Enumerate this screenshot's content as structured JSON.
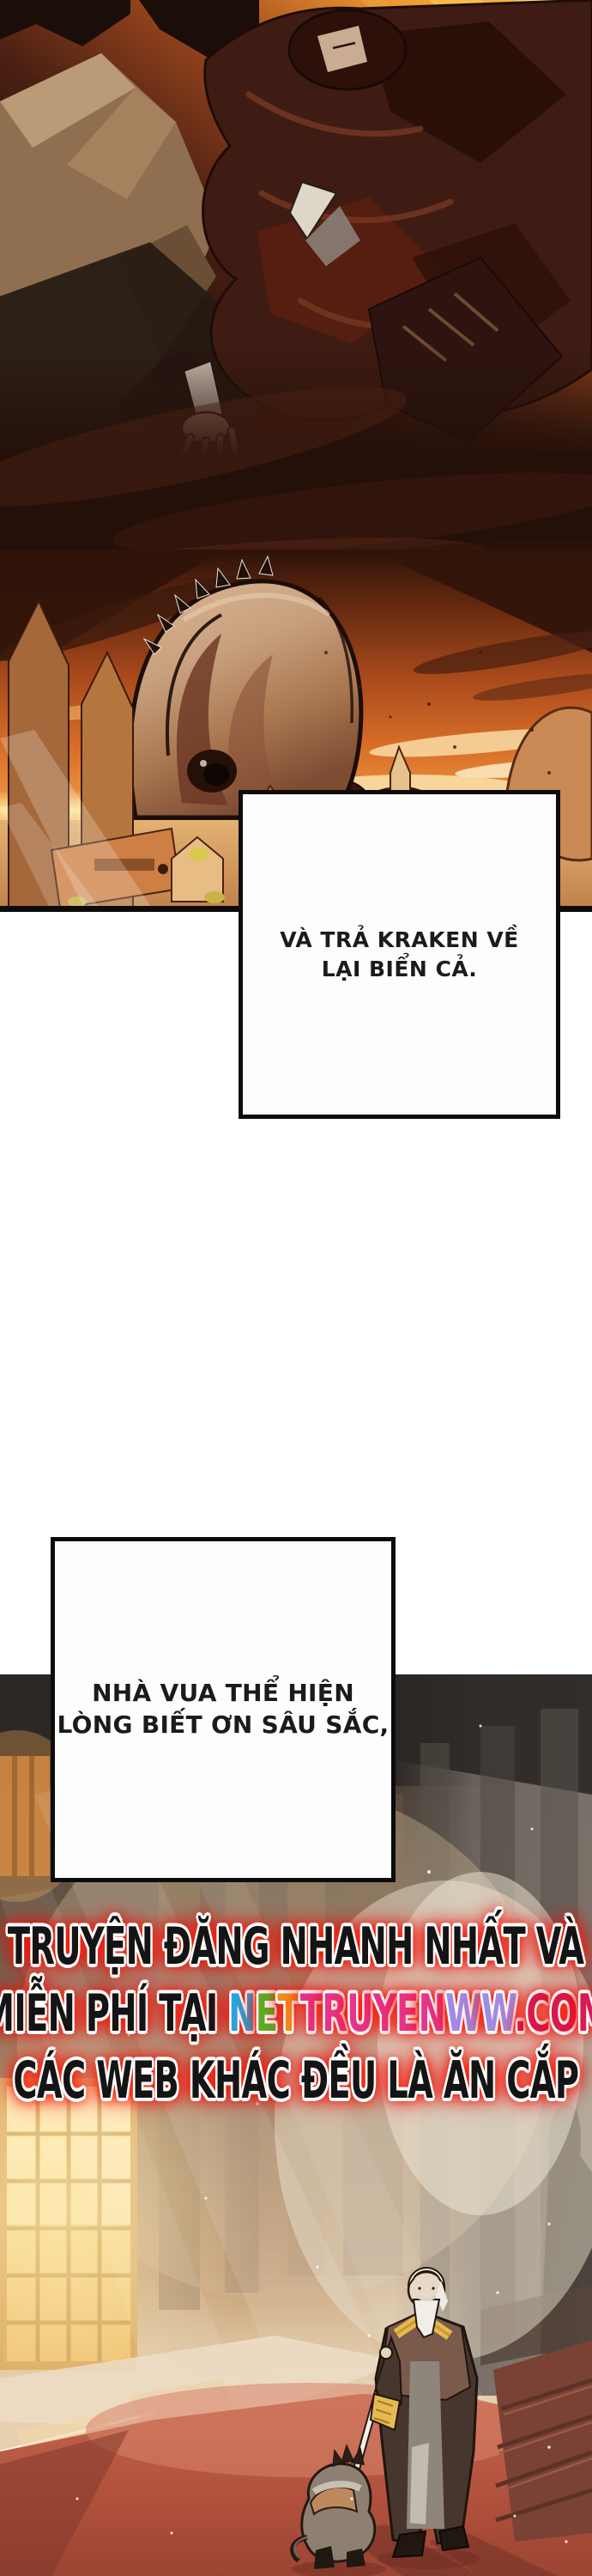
{
  "comic": {
    "speech_box_1": {
      "line1": "VÀ TRẢ KRAKEN VỀ",
      "line2": "LẠI BIỂN CẢ."
    },
    "speech_box_2": {
      "line1": "NHÀ VUA THỂ HIỆN",
      "line2": "LÒNG BIẾT ƠN SÂU SẮC,"
    },
    "watermark": {
      "line1": "TRUYỆN ĐĂNG NHANH NHẤT VÀ",
      "line2_prefix": "MIỄN PHÍ TẠI ",
      "site_letters": [
        {
          "ch": "N",
          "color": "#22aae2"
        },
        {
          "ch": "E",
          "color": "#58b32a"
        },
        {
          "ch": "T",
          "color": "#f2901e"
        },
        {
          "ch": "T",
          "color": "#e8368f"
        },
        {
          "ch": "R",
          "color": "#e8368f"
        },
        {
          "ch": "U",
          "color": "#e8368f"
        },
        {
          "ch": "Y",
          "color": "#e8368f"
        },
        {
          "ch": "E",
          "color": "#e8368f"
        },
        {
          "ch": "N",
          "color": "#e8368f"
        },
        {
          "ch": "W",
          "color": "#a18ce2"
        },
        {
          "ch": "W",
          "color": "#a18ce2"
        },
        {
          "ch": ".",
          "color": "#d81b50"
        },
        {
          "ch": "C",
          "color": "#d81b50"
        },
        {
          "ch": "O",
          "color": "#d81b50"
        },
        {
          "ch": "M",
          "color": "#d81b50"
        }
      ],
      "line3": "CÁC WEB KHÁC ĐỀU LÀ ĂN CẮP",
      "glow_color": "#ff1200",
      "outline_color": "#ffffff",
      "text_color": "#141414"
    },
    "colors": {
      "page_bg": "#ffffff",
      "panel_border": "#0d0b09",
      "sunset_sky": "#d96f28",
      "horizon_glow": "#fde296",
      "kraken_body": "#c79f7d",
      "carpet_red": "#bb5b45",
      "window_gold": "#f6d98e",
      "speech_text": "#1b1b1b"
    }
  }
}
